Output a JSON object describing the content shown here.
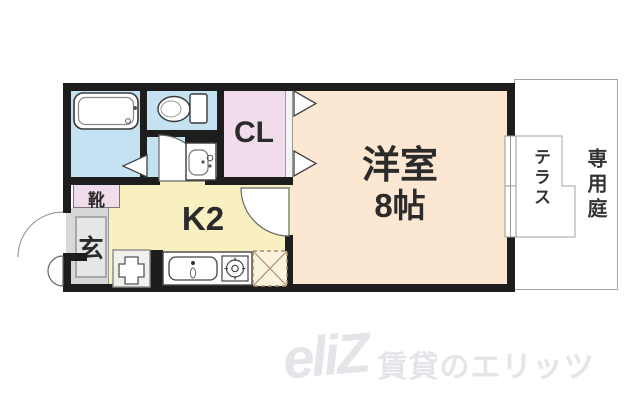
{
  "rooms": {
    "western_room": {
      "line1": "洋室",
      "line2": "8帖"
    },
    "kitchen": {
      "label": "K2"
    },
    "closet": {
      "label": "CL"
    },
    "entrance": {
      "label": "玄"
    },
    "shoe_cabinet": {
      "label": "靴"
    },
    "terrace": {
      "label": "テラス"
    },
    "private_garden": {
      "label": "専用庭"
    }
  },
  "watermark": {
    "logo": "eliZ",
    "text": "賃貸のエリッツ"
  },
  "colors": {
    "wall": "#1d1d1d",
    "wet_area_blue": "#c5e2f2",
    "closet_pink": "#f0dcea",
    "kitchen_yellow": "#f9f0c2",
    "room_beige": "#fce7d2",
    "entrance_gray": "#d8d8d8",
    "outline_gray": "#a5a5a5",
    "watermark_gray": "#e5e5e9"
  },
  "icons": {
    "bathtub": "bathtub-icon",
    "toilet": "toilet-icon",
    "washbasin": "washbasin-icon",
    "kitchen_sink": "kitchen-sink-icon",
    "stove": "stove-icon",
    "refrigerator_space": "refrigerator-space-icon",
    "washer_space": "washer-space-icon",
    "window": "window-icon",
    "door_swing": "door-swing-icon",
    "folding_door": "folding-door-icon",
    "closet_door": "closet-door-icon",
    "entrance_door": "entrance-door-icon"
  }
}
